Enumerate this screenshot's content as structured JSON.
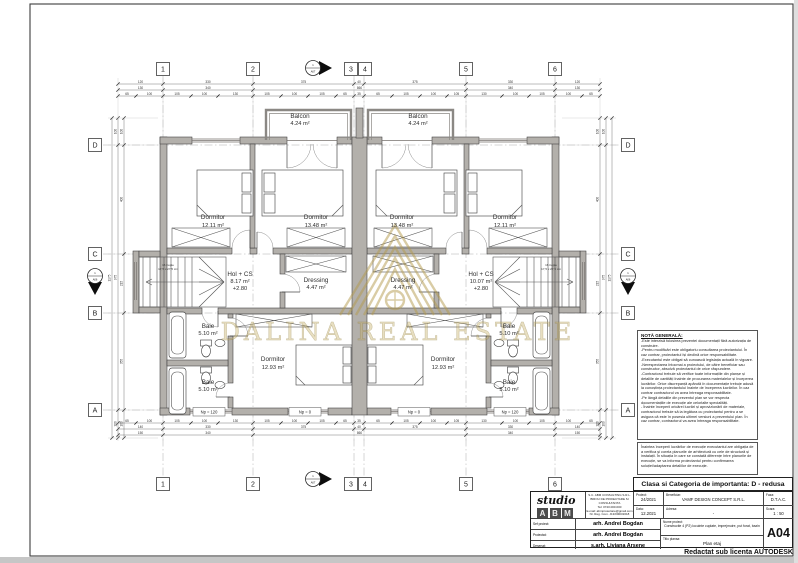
{
  "sheet": {
    "watermark_text": "DALINA REAL ESTATE",
    "autodesk_note": "Redactat sub licenta AUTODESK",
    "importance_class": "Clasa si Categoria de importanta: D - redusa",
    "colors": {
      "wall_fill": "#b3b0ab",
      "watermark_gold": "#b49b4e",
      "line": "#3a3a3a"
    }
  },
  "grid": {
    "columns": [
      "1",
      "2",
      "3",
      "4",
      "5",
      "6"
    ],
    "rows": [
      "D",
      "C",
      "B",
      "A"
    ],
    "section_num": "1",
    "section_top": "A07",
    "section_side": "A06"
  },
  "plan": {
    "rooms": [
      {
        "name": "Balcon",
        "area": "4.24 m²"
      },
      {
        "name": "Balcon",
        "area": "4.24 m²"
      },
      {
        "name": "Dormitor",
        "area": "12.11 m²"
      },
      {
        "name": "Dormitor",
        "area": "13.48 m²"
      },
      {
        "name": "Dormitor",
        "area": "13.48 m²"
      },
      {
        "name": "Dormitor",
        "area": "12.11 m²"
      },
      {
        "name": "Hol + CS",
        "area": "8.17 m²",
        "level": "+2.80"
      },
      {
        "name": "Hol + CS",
        "area": "10.07 m²",
        "level": "+2.80"
      },
      {
        "name": "Dressing",
        "area": "4.47 m²"
      },
      {
        "name": "Dressing",
        "area": "4.47 m²"
      },
      {
        "name": "Baie",
        "area": "5.10 m²"
      },
      {
        "name": "Baie",
        "area": "5.10 m²"
      },
      {
        "name": "Baie",
        "area": "5.10 m²"
      },
      {
        "name": "Baie",
        "area": "5.10 m²"
      },
      {
        "name": "Dormitor",
        "area": "12.93 m²"
      },
      {
        "name": "Dormitor",
        "area": "12.93 m²"
      }
    ],
    "stair_note_1": "16 trepte",
    "stair_note_2": "17,5 x 27,5 cm",
    "sill_labels": [
      "Np = 120",
      "Np = 0",
      "Np = 0",
      "Np = 120"
    ]
  },
  "dimensions": {
    "top": {
      "row1": [
        "120",
        "330",
        "375",
        "40",
        "375",
        "330",
        "120"
      ],
      "row2": [
        "130",
        "340",
        "860",
        "340",
        "130"
      ],
      "row3": [
        "65",
        "100",
        "105",
        "100",
        "130",
        "105",
        "100",
        "105",
        "65",
        "35",
        "65",
        "105",
        "100",
        "105",
        "130",
        "100",
        "105",
        "100",
        "65"
      ]
    },
    "bottom": {
      "row1": [
        "140",
        "330",
        "375",
        "40",
        "375",
        "330",
        "140"
      ],
      "row2": [
        "150",
        "340",
        "860",
        "340",
        "150"
      ],
      "row3": [
        "65",
        "100",
        "105",
        "100",
        "130",
        "105",
        "100",
        "105",
        "65",
        "35",
        "65",
        "105",
        "100",
        "105",
        "130",
        "100",
        "105",
        "100",
        "65"
      ]
    },
    "left": {
      "col1": [
        "100",
        "400",
        "215",
        "355",
        "100"
      ],
      "col2": [
        "100",
        "975",
        "100"
      ],
      "col3": [
        "1175"
      ]
    },
    "right": {
      "col1": [
        "100",
        "400",
        "215",
        "355",
        "100"
      ],
      "col2": [
        "100",
        "975",
        "100"
      ],
      "col3": [
        "1175"
      ]
    }
  },
  "notes": {
    "title": "NOTĂ GENERALĂ:",
    "items": [
      "-Este interzisă folosirea prezentei documentații fără autorizația de construire.",
      "-Pentru modificări este obligatoriu consultarea proiectantului. În caz contrar, proiectantul își declină orice responsabilitate.",
      "-Executantul este obligat să cunoască legislația actuală în vigoare.",
      "-Nerespectarea întocmai a proiectului, de către beneficiar sau constructor, absolvă proiectantul de orice răspundere.",
      "-Contractorul trebuie să verifice toate informațiile din planșe și detaliile de cantități înainte de procurarea materialelor și începerea lucrărilor. Orice discrepanță apărută în documentație trebuie adusă la cunoștința proiectantului înainte de începerea lucrărilor. În caz contrar contractorul va avea întreaga responsabilitate.",
      "-Pe lângă detaliile din prezentul plan se vor respecta documentațiile de execuție ale celorlalte specialități.",
      "- Înainte începerii oricărei lucrări și aprovizionării de materiale, contractorul trebuie să ia legătura cu proiectantul pentru a se asigura că este în posesia ultimei versiuni a prezentului plan. În caz contrar, contractorul va avea întreaga responsabilitate."
    ],
    "pre_exec_note": "Înaintea începerii lucrărilor de execuție executantul are obligația de a verifica și corela planurile de arhitectură cu cele de structură și instalații. În situația în care se constată diferențe între planurile de execuție, se va informa proiectantul pentru confirmarea soluției/adaptarea detaliilor de execuție."
  },
  "titleblock": {
    "studio_name": "studio",
    "studio_letters": [
      "A",
      "B",
      "M"
    ],
    "company_lines": [
      "S.C. ABM CONSULTING S.R.L.",
      "BIROU DE PROIECTARE SI CONSULTANTA",
      "Tel: 0740.000.000",
      "E-mail: abmproiectare@gmail.com",
      "Nr. Reg. Com. J13/0000/2018"
    ],
    "rows": [
      {
        "label": "Sef proiect:",
        "value": "arh. Andrei Bogdan"
      },
      {
        "label": "Proiectat:",
        "value": "arh. Andrei Bogdan"
      },
      {
        "label": "Desenat:",
        "value": "s.arh. Liviana Arsene"
      }
    ],
    "proiect_label": "Proiect:",
    "proiect_value": "24/2021",
    "data_label": "Data:",
    "data_value": "12.2021",
    "beneficiar_label": "Beneficiar:",
    "beneficiar_value": "VAMF DESIGN CONCEPT S.R.L.",
    "adresa_label": "Adresa:",
    "adresa_value": "-",
    "faza_label": "Faza:",
    "faza_value": "D.T.A.C.",
    "scara_label": "Scara:",
    "scara_value": "1 : 50",
    "nume_label": "Nume proiect:",
    "nume_value": "Constructie 4 (P2) locuinte cuplate, imprejmuire, put forat, bazin",
    "titlu_label": "Titlu plansa:",
    "titlu_value": "Plan etaj",
    "plansa_nr": "A04"
  }
}
